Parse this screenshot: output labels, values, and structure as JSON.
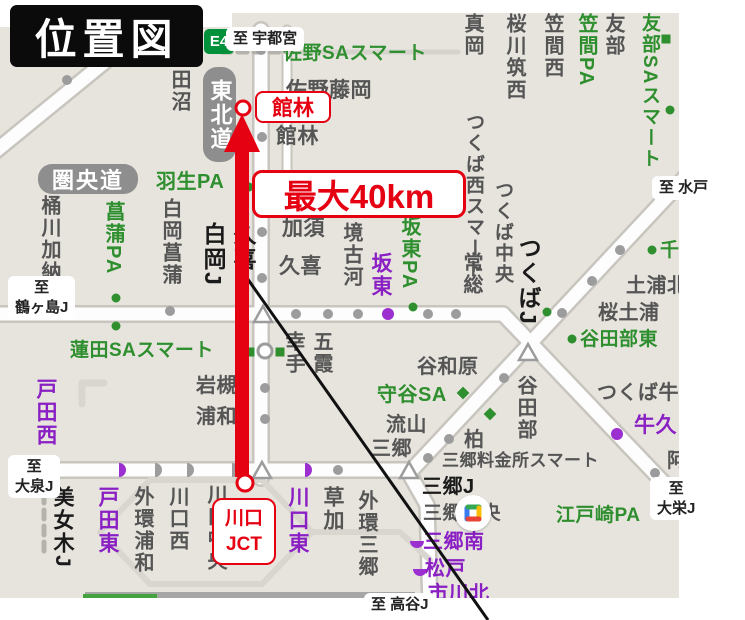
{
  "title": "位置図",
  "annotations": {
    "tatebayashi": "館林",
    "distance": "最大40km",
    "kawaguchi_jct": "川口\nJCT"
  },
  "road_badges": {
    "tohoku_expwy": "東北道",
    "kenodo_expwy": "圏央道",
    "route_number": "E4"
  },
  "palette": {
    "map_bg": "#e7e4de",
    "red": "#e50012",
    "green": "#2f8f2f",
    "purple": "#8a1fc4",
    "gray_text": "#555555",
    "road_fill": "#fdfdfd",
    "road_casing": "#c8c5bf"
  },
  "direction_tags": [
    {
      "t": "至 宇都宮",
      "x": 226,
      "y": 27
    },
    {
      "t": "至 水戸",
      "x": 652,
      "y": 176
    },
    {
      "t": "至\n鶴ヶ島J",
      "x": 8,
      "y": 276
    },
    {
      "t": "至\n大泉J",
      "x": 8,
      "y": 455
    },
    {
      "t": "至 高谷J",
      "x": 364,
      "y": 593
    },
    {
      "t": "至\n大栄J",
      "x": 650,
      "y": 477
    }
  ],
  "map_labels": [
    {
      "t": "佐野SAスマート",
      "x": 283,
      "y": 44,
      "c": "gr",
      "s": 19
    },
    {
      "t": "佐野藤岡",
      "x": 286,
      "y": 80,
      "s": 21
    },
    {
      "t": "館林",
      "x": 276,
      "y": 126,
      "s": 21
    },
    {
      "t": "田沼",
      "x": 169,
      "y": 69,
      "v": 1
    },
    {
      "t": "真岡",
      "x": 462,
      "y": 13,
      "v": 1
    },
    {
      "t": "桜川筑西",
      "x": 504,
      "y": 13,
      "v": 1
    },
    {
      "t": "笠間西",
      "x": 542,
      "y": 13,
      "v": 1
    },
    {
      "t": "笠間PA",
      "x": 576,
      "y": 13,
      "v": 1,
      "c": "gr"
    },
    {
      "t": "友部",
      "x": 603,
      "y": 13,
      "v": 1
    },
    {
      "t": "友部SAスマート",
      "x": 640,
      "y": 13,
      "v": 1,
      "c": "gr",
      "s": 19
    },
    {
      "t": "羽生PA",
      "x": 156,
      "y": 172,
      "c": "gr"
    },
    {
      "t": "桶川加納",
      "x": 39,
      "y": 195,
      "v": 1
    },
    {
      "t": "菖蒲PA",
      "x": 103,
      "y": 201,
      "v": 1,
      "c": "gr"
    },
    {
      "t": "白岡菖蒲",
      "x": 160,
      "y": 198,
      "v": 1
    },
    {
      "t": "白岡J",
      "x": 201,
      "y": 222,
      "v": 1,
      "c": "k",
      "s": 23
    },
    {
      "t": "久喜",
      "x": 231,
      "y": 222,
      "v": 1,
      "c": "k",
      "s": 23
    },
    {
      "t": "加須",
      "x": 282,
      "y": 218,
      "s": 21
    },
    {
      "t": "久喜",
      "x": 279,
      "y": 256,
      "s": 21
    },
    {
      "t": "境古河",
      "x": 341,
      "y": 222,
      "v": 1
    },
    {
      "t": "坂東",
      "x": 370,
      "y": 252,
      "v": 1,
      "c": "p",
      "s": 21
    },
    {
      "t": "坂東PA",
      "x": 399,
      "y": 216,
      "v": 1,
      "c": "gr"
    },
    {
      "t": "常総",
      "x": 461,
      "y": 252,
      "v": 1
    },
    {
      "t": "つくば西スマート",
      "x": 464,
      "y": 112,
      "v": 1,
      "s": 19
    },
    {
      "t": "つくば中央",
      "x": 493,
      "y": 180,
      "v": 1,
      "s": 19
    },
    {
      "t": "つくばJ",
      "x": 516,
      "y": 236,
      "v": 1,
      "c": "k",
      "s": 23
    },
    {
      "t": "幸手",
      "x": 283,
      "y": 331,
      "v": 1
    },
    {
      "t": "五霞",
      "x": 311,
      "y": 331,
      "v": 1
    },
    {
      "t": "蓮田SAスマート",
      "x": 70,
      "y": 341,
      "c": "gr",
      "s": 19
    },
    {
      "t": "岩槻",
      "x": 196,
      "y": 376
    },
    {
      "t": "浦和",
      "x": 196,
      "y": 407
    },
    {
      "t": "谷和原",
      "x": 417,
      "y": 357
    },
    {
      "t": "守谷SA",
      "x": 377,
      "y": 385,
      "c": "gr"
    },
    {
      "t": "流山",
      "x": 386,
      "y": 415
    },
    {
      "t": "三郷",
      "x": 371,
      "y": 439
    },
    {
      "t": "柏",
      "x": 464,
      "y": 430
    },
    {
      "t": "谷田部",
      "x": 515,
      "y": 375,
      "v": 1
    },
    {
      "t": "谷田部東",
      "x": 580,
      "y": 330,
      "c": "gr",
      "s": 19
    },
    {
      "t": "桜土浦",
      "x": 598,
      "y": 303
    },
    {
      "t": "土浦北",
      "x": 626,
      "y": 276
    },
    {
      "t": "千",
      "x": 660,
      "y": 241,
      "c": "gr",
      "s": 19
    },
    {
      "t": "つくば牛久",
      "x": 597,
      "y": 383
    },
    {
      "t": "牛久",
      "x": 634,
      "y": 415,
      "c": "p",
      "s": 21
    },
    {
      "t": "阿見東",
      "x": 667,
      "y": 451
    },
    {
      "t": "三郷料金所スマート",
      "x": 442,
      "y": 452,
      "s": 17
    },
    {
      "t": "三郷J",
      "x": 422,
      "y": 477,
      "c": "k",
      "s": 20
    },
    {
      "t": "三郷中央",
      "x": 423,
      "y": 504,
      "s": 19
    },
    {
      "t": "三郷南",
      "x": 423,
      "y": 532,
      "c": "p"
    },
    {
      "t": "松戸",
      "x": 425,
      "y": 559,
      "c": "p"
    },
    {
      "t": "市川北",
      "x": 428,
      "y": 584,
      "c": "p"
    },
    {
      "t": "江戸崎PA",
      "x": 556,
      "y": 506,
      "c": "gr",
      "s": 19
    },
    {
      "t": "戸田西",
      "x": 35,
      "y": 378,
      "v": 1,
      "c": "p",
      "s": 21
    },
    {
      "t": "美女木J",
      "x": 52,
      "y": 486,
      "v": 1,
      "c": "k",
      "s": 21
    },
    {
      "t": "戸田東",
      "x": 97,
      "y": 486,
      "v": 1,
      "c": "p",
      "s": 21
    },
    {
      "t": "外環浦和",
      "x": 132,
      "y": 486,
      "v": 1
    },
    {
      "t": "川口西",
      "x": 167,
      "y": 486,
      "v": 1
    },
    {
      "t": "川口中央",
      "x": 205,
      "y": 484,
      "v": 1
    },
    {
      "t": "川口東",
      "x": 287,
      "y": 486,
      "v": 1,
      "c": "p",
      "s": 21
    },
    {
      "t": "草加",
      "x": 322,
      "y": 486,
      "v": 1,
      "s": 21
    },
    {
      "t": "外環三郷",
      "x": 356,
      "y": 490,
      "v": 1
    }
  ],
  "markers": [
    {
      "ty": "dot",
      "x": 67,
      "y": 80
    },
    {
      "ty": "dot",
      "x": 261,
      "y": 50
    },
    {
      "ty": "dot",
      "x": 262,
      "y": 137
    },
    {
      "ty": "dot",
      "x": 262,
      "y": 232
    },
    {
      "ty": "dot",
      "x": 262,
      "y": 278
    },
    {
      "ty": "dot",
      "x": 265,
      "y": 388
    },
    {
      "ty": "dot",
      "x": 265,
      "y": 419
    },
    {
      "ty": "dot",
      "x": 170,
      "y": 311
    },
    {
      "ty": "dot",
      "x": 296,
      "y": 314
    },
    {
      "ty": "dot",
      "x": 328,
      "y": 314
    },
    {
      "ty": "dot",
      "x": 358,
      "y": 314
    },
    {
      "ty": "dot",
      "x": 428,
      "y": 314
    },
    {
      "ty": "dot",
      "x": 456,
      "y": 314
    },
    {
      "ty": "dot",
      "x": 428,
      "y": 458
    },
    {
      "ty": "dot",
      "x": 449,
      "y": 439
    },
    {
      "ty": "dot",
      "x": 504,
      "y": 378
    },
    {
      "ty": "dot",
      "x": 562,
      "y": 313
    },
    {
      "ty": "dot",
      "x": 592,
      "y": 281
    },
    {
      "ty": "dot",
      "x": 620,
      "y": 250
    },
    {
      "ty": "dot",
      "x": 672,
      "y": 192
    },
    {
      "ty": "dot",
      "x": 655,
      "y": 473
    },
    {
      "ty": "dot",
      "x": 338,
      "y": 470
    },
    {
      "ty": "dot",
      "x": 388,
      "y": 314,
      "c": "purple",
      "r": 6
    },
    {
      "ty": "dot",
      "x": 617,
      "y": 434,
      "c": "purple",
      "r": 6
    },
    {
      "ty": "dot",
      "x": 249,
      "y": 187,
      "c": "green",
      "r": 4.5
    },
    {
      "ty": "dot",
      "x": 116,
      "y": 298,
      "c": "green",
      "r": 4.5
    },
    {
      "ty": "dot",
      "x": 116,
      "y": 326,
      "c": "green",
      "r": 4.5
    },
    {
      "ty": "dot",
      "x": 413,
      "y": 307,
      "c": "green",
      "r": 4.5
    },
    {
      "ty": "dot",
      "x": 572,
      "y": 339,
      "c": "green",
      "r": 4.5
    },
    {
      "ty": "dot",
      "x": 547,
      "y": 312,
      "c": "green",
      "r": 4.5
    },
    {
      "ty": "dot",
      "x": 652,
      "y": 250,
      "c": "green",
      "r": 4.5
    },
    {
      "ty": "dot",
      "x": 670,
      "y": 110,
      "c": "green",
      "r": 4.5
    },
    {
      "ty": "sq",
      "x": 666,
      "y": 39,
      "c": "green"
    },
    {
      "ty": "sq",
      "x": 250,
      "y": 352,
      "c": "green"
    },
    {
      "ty": "sq",
      "x": 280,
      "y": 352,
      "c": "green"
    },
    {
      "ty": "dia",
      "x": 463,
      "y": 393,
      "c": "green"
    },
    {
      "ty": "dia",
      "x": 490,
      "y": 414,
      "c": "green"
    },
    {
      "ty": "jct-circle",
      "x": 265,
      "y": 351
    },
    {
      "ty": "half-right",
      "x": 119,
      "y": 470,
      "c": "purple"
    },
    {
      "ty": "half-right",
      "x": 305,
      "y": 470,
      "c": "purple"
    },
    {
      "ty": "half-right",
      "x": 155,
      "y": 470
    },
    {
      "ty": "half-right",
      "x": 187,
      "y": 470
    },
    {
      "ty": "half-right",
      "x": 232,
      "y": 470
    },
    {
      "ty": "half-down",
      "x": 417,
      "y": 541,
      "c": "purple"
    },
    {
      "ty": "half-down",
      "x": 420,
      "y": 569,
      "c": "purple"
    },
    {
      "ty": "triangle",
      "x": 263,
      "y": 315
    },
    {
      "ty": "triangle",
      "x": 528,
      "y": 353
    },
    {
      "ty": "triangle",
      "x": 262,
      "y": 471
    },
    {
      "ty": "triangle",
      "x": 409,
      "y": 471
    }
  ]
}
